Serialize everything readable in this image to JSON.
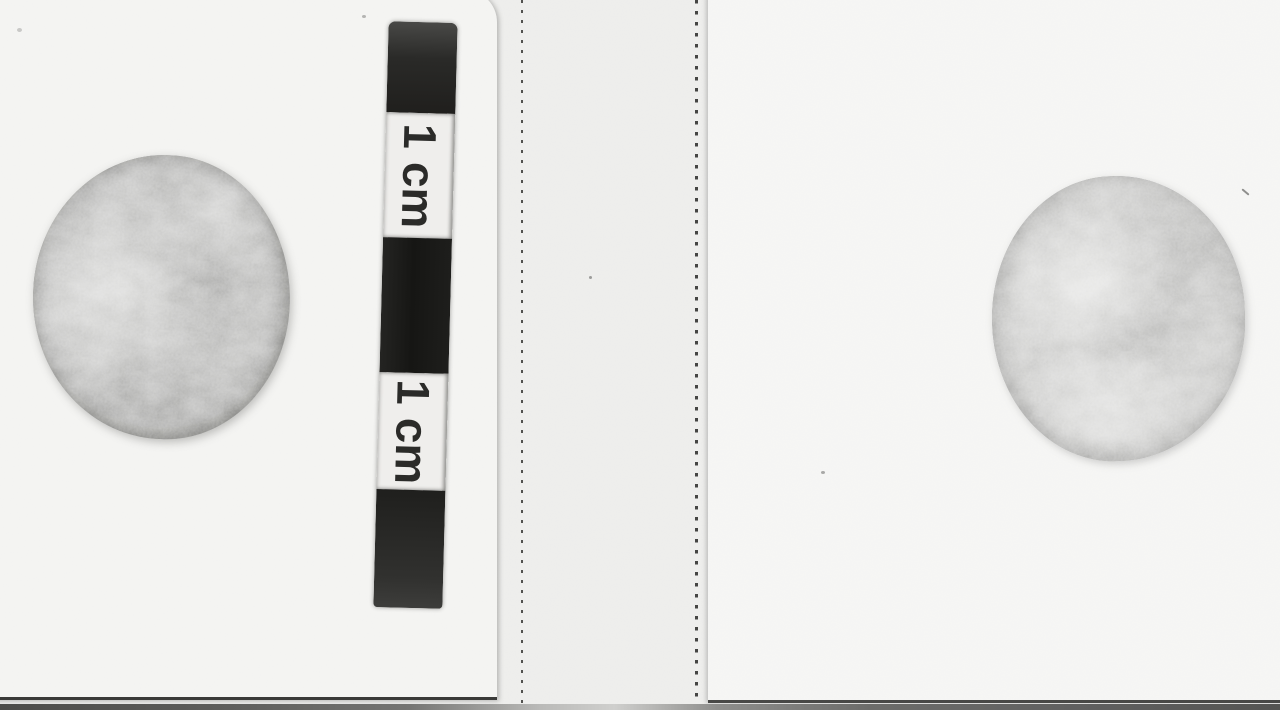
{
  "figure": {
    "description": "Greyscale photograph of two worn coin faces mounted on two white paper sheets separated by a perforated backing strip, with a segmented centimetre scale bar beside the left coin",
    "left_coin_name": "left coin face",
    "right_coin_name": "right coin face"
  },
  "scale_bar": {
    "unit_labels": [
      "1 cm",
      "1 cm"
    ],
    "segments": [
      "black",
      "white",
      "black",
      "white",
      "black"
    ],
    "label_orientation": "rotated-90-clockwise"
  },
  "colors": {
    "backing": "#ebebe9",
    "paper_left": "#f2f2f0",
    "paper_right": "#f4f4f2",
    "bar_black": "#1c1c1a",
    "bar_white": "#efeeec",
    "label_ink": "#2b2b29",
    "coin_left_base": "#a2a2a0",
    "coin_right_base": "#b5b5b3",
    "table_edge": "#4e4e4c"
  }
}
